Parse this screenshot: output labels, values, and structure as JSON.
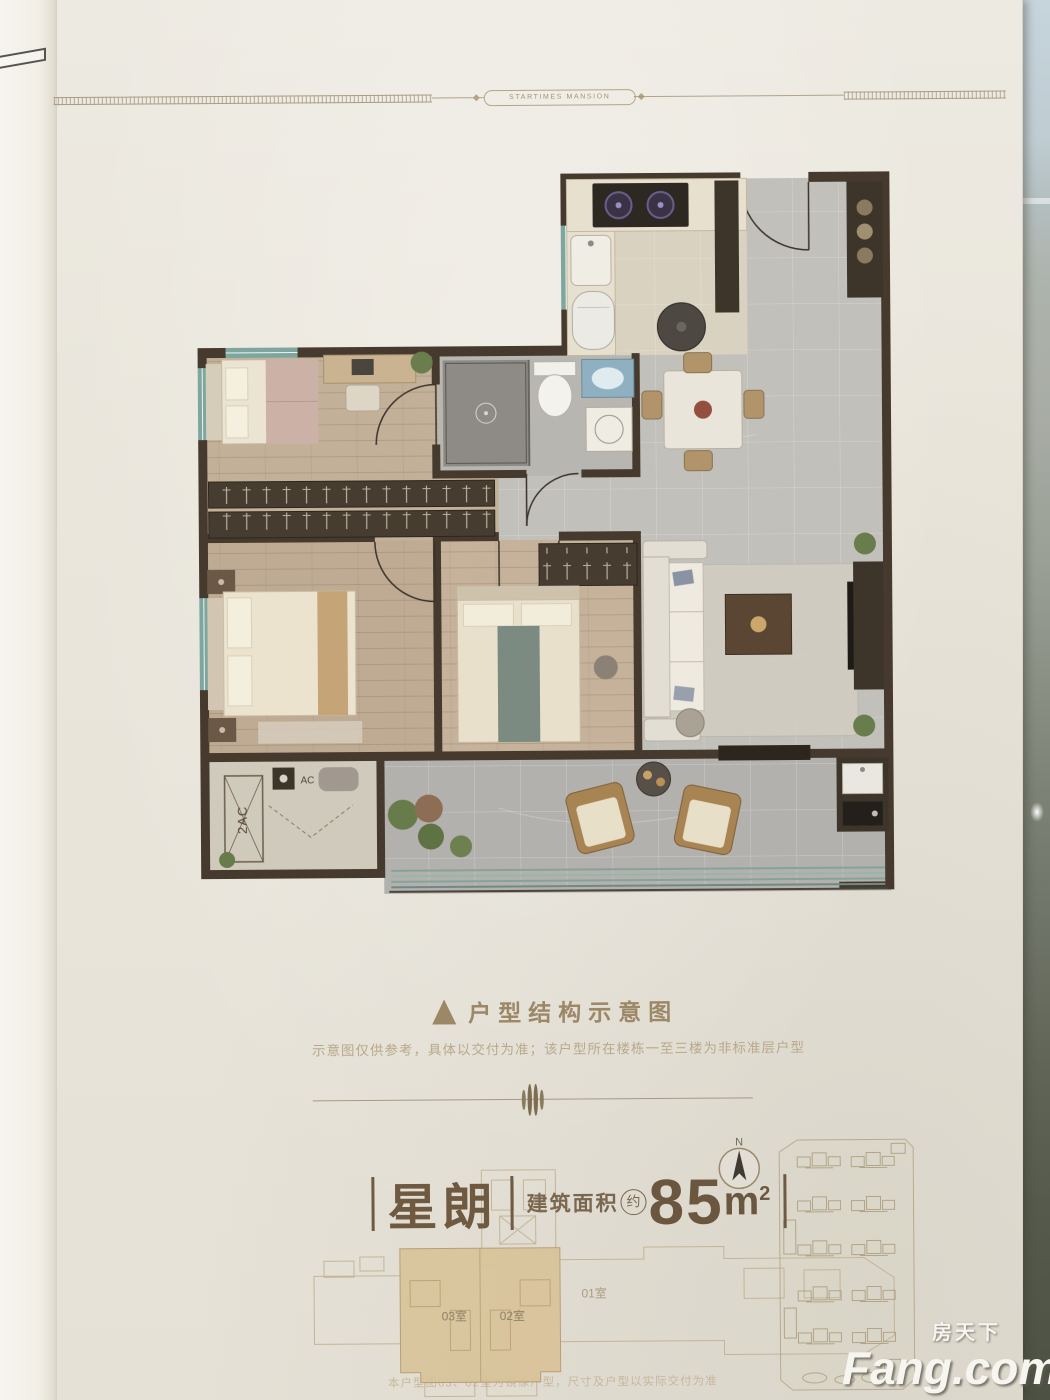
{
  "photo": {
    "brand_motto": "STARTIMES MANSION",
    "section": {
      "caption": "户型结构示意图",
      "disclaimer": "示意图仅供参考，具体以交付为准；该户型所在楼栋一至三楼为非标准层户型"
    },
    "unit": {
      "name": "星朗",
      "area_label": "建筑面积",
      "area_approx": "约",
      "area_value": "85",
      "area_unit": "m",
      "area_exp": "2"
    },
    "floorplan": {
      "ac_platform_label": "2AC",
      "ac_label": "AC"
    },
    "keyplan": {
      "unit_03": "03室",
      "unit_02": "02室",
      "unit_01": "01室",
      "note": "本户型图03、02室为镜像户型，尺寸及户型以实际交付为准"
    },
    "compass": {
      "north": "N"
    },
    "watermark": {
      "cn": "房天下",
      "en": "Fang.com"
    },
    "colors": {
      "accent_tan": "#9c8767",
      "unit_text": "#6f5940",
      "keyplan_highlight": "#d9c298",
      "page_background": "#eae6dd"
    }
  }
}
